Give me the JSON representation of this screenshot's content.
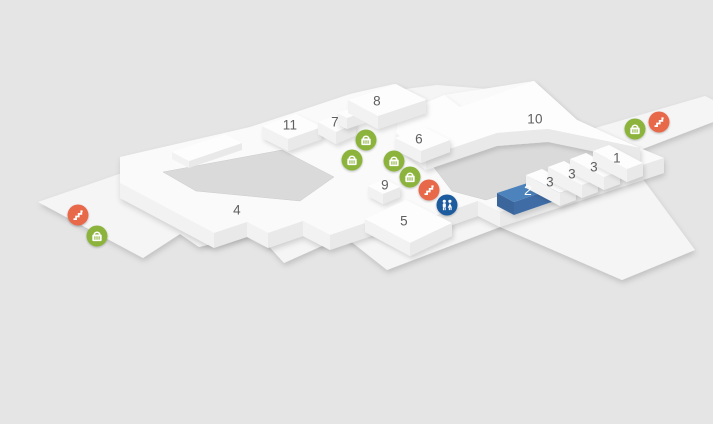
{
  "map": {
    "title": "shopping-centre-floor-plan",
    "colors": {
      "background": "#e5e5e5",
      "base_platform": "#f5f5f5",
      "floor_slab": "#fafafa",
      "block_top": "#fdfdfd",
      "courtyard": "#dadada",
      "highlight_unit": "#4d83bd",
      "highlight_unit_side": "#3a669c",
      "shop_icon": "#8cb43d",
      "escalator_icon": "#e8684a",
      "restroom_icon": "#1d5b9f",
      "label_text": "#5f5f5f",
      "highlight_label_text": "#ffffff"
    },
    "units": [
      {
        "label": "4",
        "x": 237,
        "y": 210,
        "highlighted": false
      },
      {
        "label": "5",
        "x": 404,
        "y": 221,
        "highlighted": false
      },
      {
        "label": "6",
        "x": 419,
        "y": 139,
        "highlighted": false
      },
      {
        "label": "7",
        "x": 335,
        "y": 122,
        "highlighted": false
      },
      {
        "label": "8",
        "x": 377,
        "y": 101,
        "highlighted": false
      },
      {
        "label": "9",
        "x": 385,
        "y": 185,
        "highlighted": false
      },
      {
        "label": "10",
        "x": 535,
        "y": 119,
        "highlighted": false
      },
      {
        "label": "11",
        "x": 290,
        "y": 125,
        "highlighted": false
      },
      {
        "label": "1",
        "x": 617,
        "y": 158,
        "highlighted": false
      },
      {
        "label": "2",
        "x": 528,
        "y": 190,
        "highlighted": true
      },
      {
        "label": "3",
        "x": 550,
        "y": 182,
        "highlighted": false
      },
      {
        "label": "3",
        "x": 572,
        "y": 174,
        "highlighted": false
      },
      {
        "label": "3",
        "x": 594,
        "y": 167,
        "highlighted": false
      }
    ],
    "icons": [
      {
        "type": "escalator",
        "x": 78,
        "y": 215
      },
      {
        "type": "shop",
        "x": 97,
        "y": 236
      },
      {
        "type": "shop",
        "x": 366,
        "y": 140
      },
      {
        "type": "shop",
        "x": 352,
        "y": 160
      },
      {
        "type": "shop",
        "x": 394,
        "y": 161
      },
      {
        "type": "shop",
        "x": 410,
        "y": 177
      },
      {
        "type": "escalator",
        "x": 429,
        "y": 190
      },
      {
        "type": "restroom",
        "x": 447,
        "y": 205
      },
      {
        "type": "shop",
        "x": 635,
        "y": 129
      },
      {
        "type": "escalator",
        "x": 659,
        "y": 122
      }
    ]
  }
}
